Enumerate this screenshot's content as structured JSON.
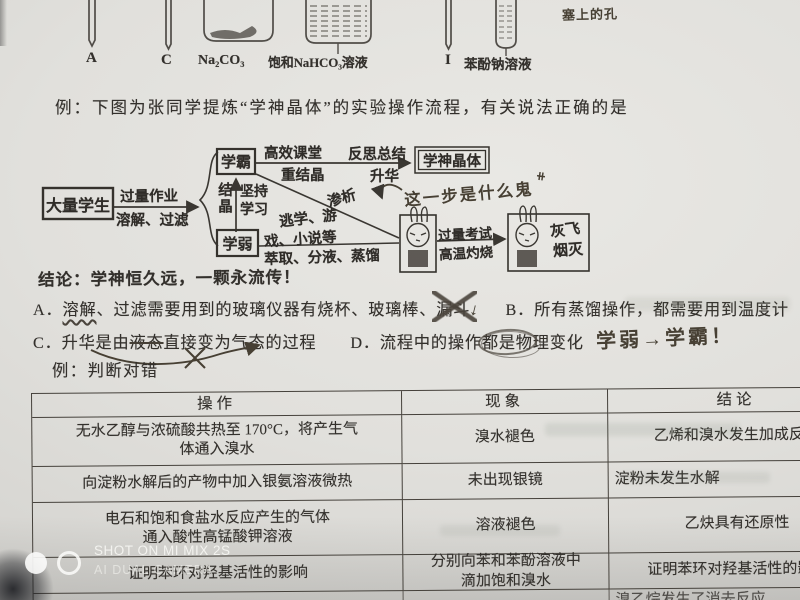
{
  "photo": {
    "apparatus": {
      "label_a": "A",
      "label_c": "C",
      "label_na2co3": "Na₂CO₃",
      "label_nahco3": "饱和NaHCO₃溶液",
      "label_i": "I",
      "label_phenol": "苯酚钠溶液",
      "handwritten_note": "塞上的孔"
    },
    "example1_prompt": "例：下图为张同学提炼“学神晶体”的实验操作流程，有关说法正确的是",
    "flowchart": {
      "start_box": "大量学生",
      "arrow1_top": "过量作业",
      "arrow1_bottom": "溶解、过滤",
      "branch_label": "结晶",
      "top_box": "学霸",
      "persist_label": "坚持学习",
      "bottom_box": "学弱",
      "arrow2_top": "高效课堂",
      "arrow2_bottom": "重结晶",
      "arrow3_top": "反思总结",
      "arrow3_bottom": "升华",
      "end_box": "学神晶体",
      "dialysis_label": "渗析",
      "distract_text_1": "逃学、游",
      "distract_text_2": "戏、小说等",
      "extract_label": "萃取、分液、蒸馏",
      "exam_top": "过量考试",
      "exam_bottom": "高温灼烧",
      "ash_text_1": "灰飞",
      "ash_text_2": "烟灭",
      "handwritten_note": "这一步是什么鬼",
      "handwritten_mark": "⧺"
    },
    "conclusion": "结论：学神恒久远，一颗永流传！",
    "options": {
      "a_head": "A．",
      "a_wavy": "溶解",
      "a_mid": "、过滤需要用到的玻璃仪器有烧杯、玻璃棒、",
      "a_crossed": "漏斗",
      "a_mark": "↓",
      "b": "B．所有蒸馏操作，都需要用到温度计",
      "c_head": "C．升华是由",
      "c_struck": "液态",
      "c_tail": "直接变为气态的过程",
      "d_head": "D．流程中的操作",
      "d_scribbled": "都是物",
      "d_tail": "理变化",
      "handwritten": "学弱→学霸！"
    },
    "example2_prompt": "例：判断对错",
    "table": {
      "headers": [
        "操作",
        "现象",
        "结论"
      ],
      "rows": [
        [
          "无水乙醇与浓硫酸共热至 170°C，将产生气\n体通入溴水",
          "溴水褪色",
          "乙烯和溴水发生加成反应"
        ],
        [
          "向淀粉水解后的产物中加入银氨溶液微热",
          "未出现银镜",
          "淀粉未发生水解"
        ],
        [
          "电石和饱和食盐水反应产生的气体\n通入酸性高锰酸钾溶液",
          "溶液褪色",
          "乙炔具有还原性"
        ],
        [
          "证明苯环对羟基活性的影响",
          "分别向苯和苯酚溶液中\n滴加饱和溴水",
          "证明苯环对羟基活性的影响"
        ],
        [
          "",
          "",
          "溴乙烷发生了消去反应"
        ]
      ]
    },
    "watermark": {
      "line1": "SHOT ON MI MIX 2S",
      "line2": "AI DUAL CAMERA"
    }
  }
}
